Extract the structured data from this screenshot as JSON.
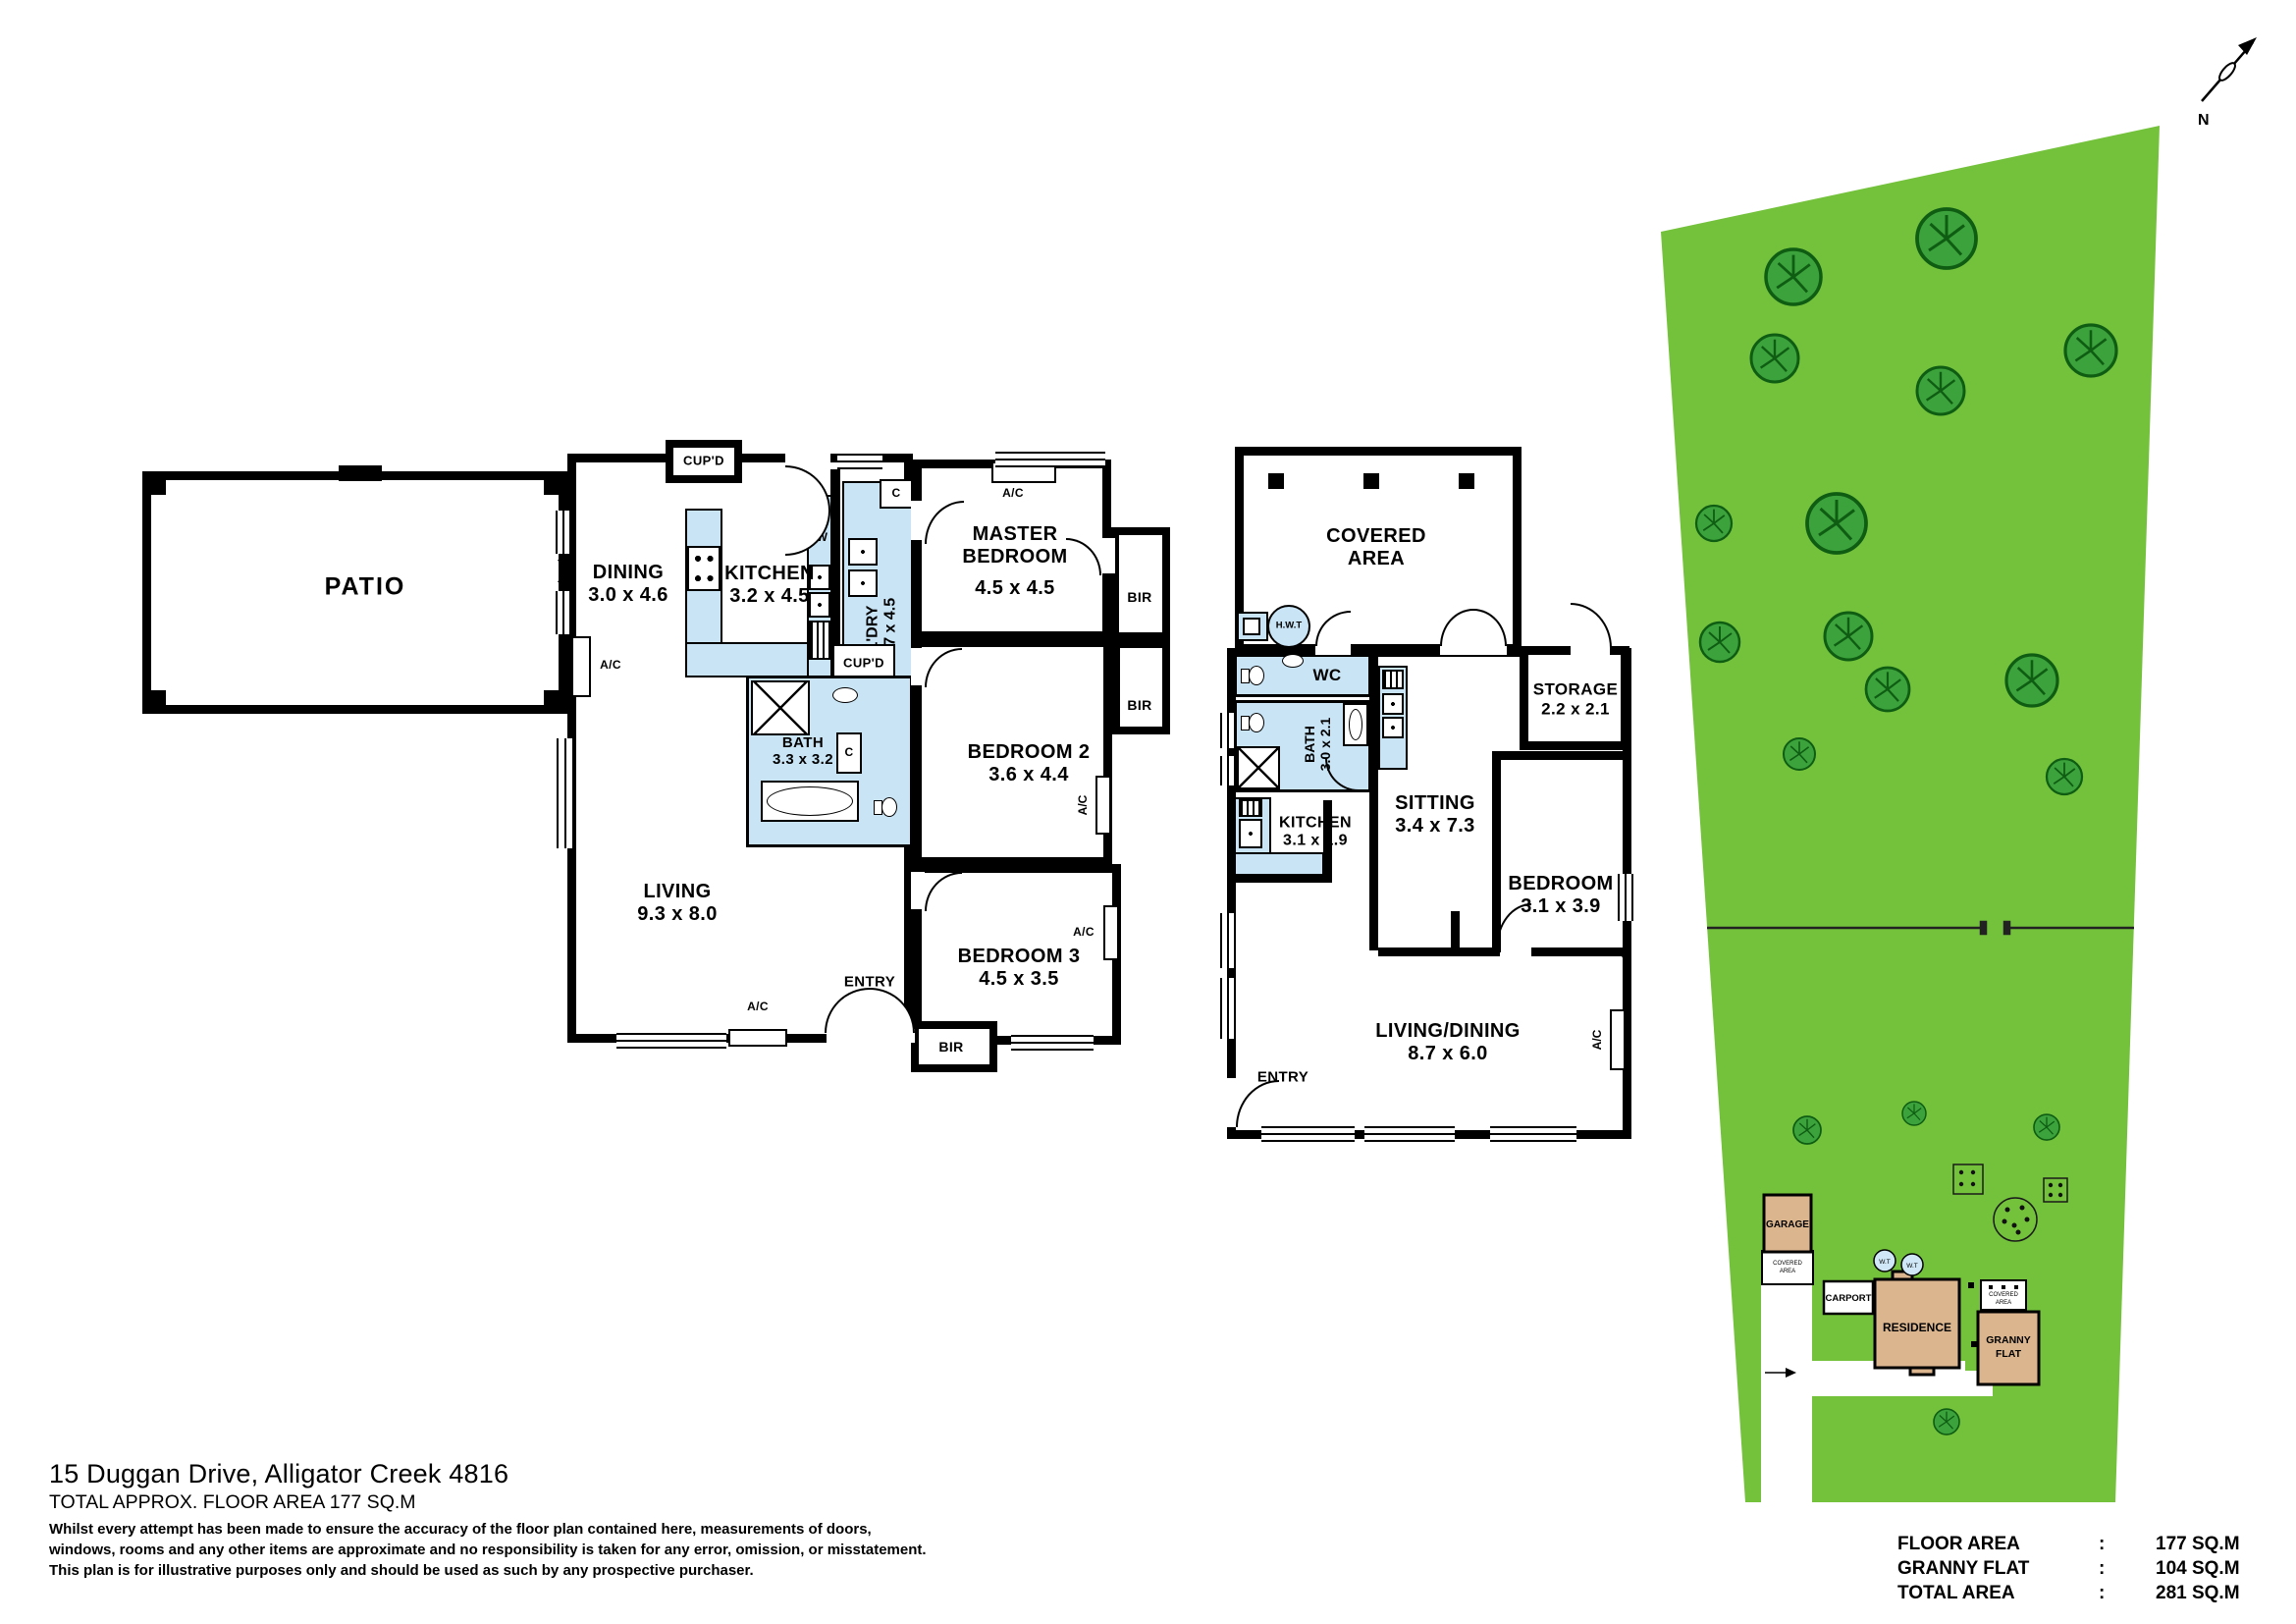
{
  "compass": {
    "north": "N"
  },
  "residence_plan": {
    "patio": "PATIO",
    "dining": {
      "name": "DINING",
      "dim": "3.0 x 4.6"
    },
    "kitchen": {
      "name": "KITCHEN",
      "dim": "3.2 x 4.5"
    },
    "laundry": {
      "name": "L'DRY",
      "dim": "1.7 x 4.5"
    },
    "cupd_top": "CUP'D",
    "cupd_mid": "CUP'D",
    "c_label": "C",
    "dw": "DW",
    "master": {
      "name1": "MASTER",
      "name2": "BEDROOM",
      "dim": "4.5 x 4.5"
    },
    "bir_master": "BIR",
    "bir_bed2": "BIR",
    "bir_bed3": "BIR",
    "bedroom2": {
      "name": "BEDROOM 2",
      "dim": "3.6 x 4.4"
    },
    "bath": {
      "name": "BATH",
      "dim": "3.3 x 3.2"
    },
    "living": {
      "name": "LIVING",
      "dim": "9.3 x 8.0"
    },
    "entry": "ENTRY",
    "bedroom3": {
      "name": "BEDROOM 3",
      "dim": "4.5 x 3.5"
    },
    "ac_label": "A/C"
  },
  "granny_plan": {
    "covered": {
      "name1": "COVERED",
      "name2": "AREA"
    },
    "hwt": "H.W.T",
    "wc": "WC",
    "bath": {
      "name": "BATH",
      "dim": "3.0 x 2.1"
    },
    "storage": {
      "name": "STORAGE",
      "dim": "2.2 x 2.1"
    },
    "kitchen": {
      "name": "KITCHEN",
      "dim": "3.1 x 1.9"
    },
    "sitting": {
      "name": "SITTING",
      "dim": "3.4 x 7.3"
    },
    "bedroom": {
      "name": "BEDROOM",
      "dim": "3.1 x 3.9"
    },
    "living_dining": {
      "name": "LIVING/DINING",
      "dim": "8.7 x 6.0"
    },
    "entry": "ENTRY",
    "ac_label": "A/C"
  },
  "site_plan": {
    "garage": "GARAGE",
    "carport": "CARPORT",
    "residence": "RESIDENCE",
    "granny1": "GRANNY",
    "granny2": "FLAT",
    "wt": "W.T",
    "covered_small1": "COVERED",
    "covered_small2": "AREA"
  },
  "footer": {
    "address": "15 Duggan Drive, Alligator Creek 4816",
    "area_line": "TOTAL APPROX. FLOOR AREA 177 SQ.M",
    "disclaimer1": "Whilst every attempt has been made to ensure the accuracy of the floor plan contained here, measurements of doors,",
    "disclaimer2": "windows, rooms and any other items are approximate and no responsibility is taken for any error, omission, or misstatement.",
    "disclaimer3": "This plan is for illustrative purposes only and should be used as such by any prospective purchaser."
  },
  "areas_table": {
    "rows": [
      {
        "label": "FLOOR AREA",
        "sep": ":",
        "value": "177 SQ.M"
      },
      {
        "label": "GRANNY FLAT",
        "sep": ":",
        "value": "104 SQ.M"
      },
      {
        "label": "TOTAL AREA",
        "sep": ":",
        "value": "281 SQ.M"
      }
    ]
  },
  "colors": {
    "land": "#74c23c",
    "tree": "#3ca33c",
    "building": "#dbb58e",
    "wet_area": "#c9e4f5",
    "wall": "#000000"
  }
}
